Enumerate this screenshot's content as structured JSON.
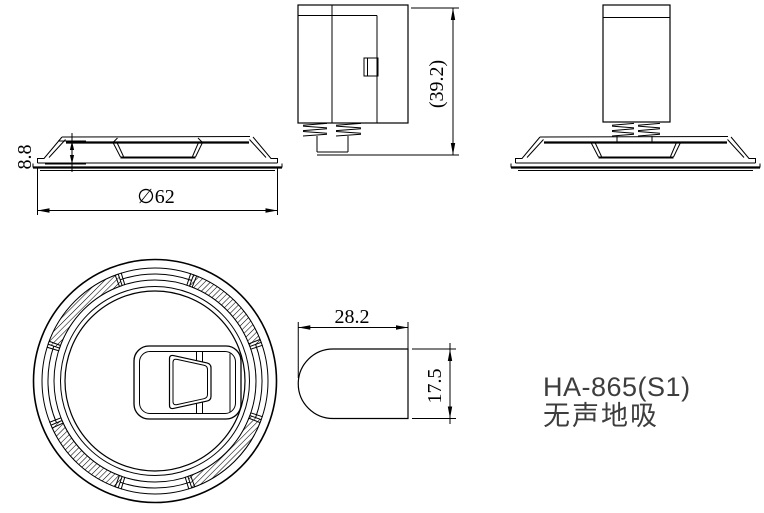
{
  "title_block": {
    "model": "HA-865(S1)",
    "product_name": "无声地吸"
  },
  "dimensions": {
    "base_diameter": "∅62",
    "base_height": "8.8",
    "overall_height": "(39.2)",
    "strike_plate_width": "28.2",
    "strike_plate_height": "17.5"
  },
  "colors": {
    "line": "#000000",
    "title_text": "#3d3d3d",
    "background": "#ffffff"
  }
}
